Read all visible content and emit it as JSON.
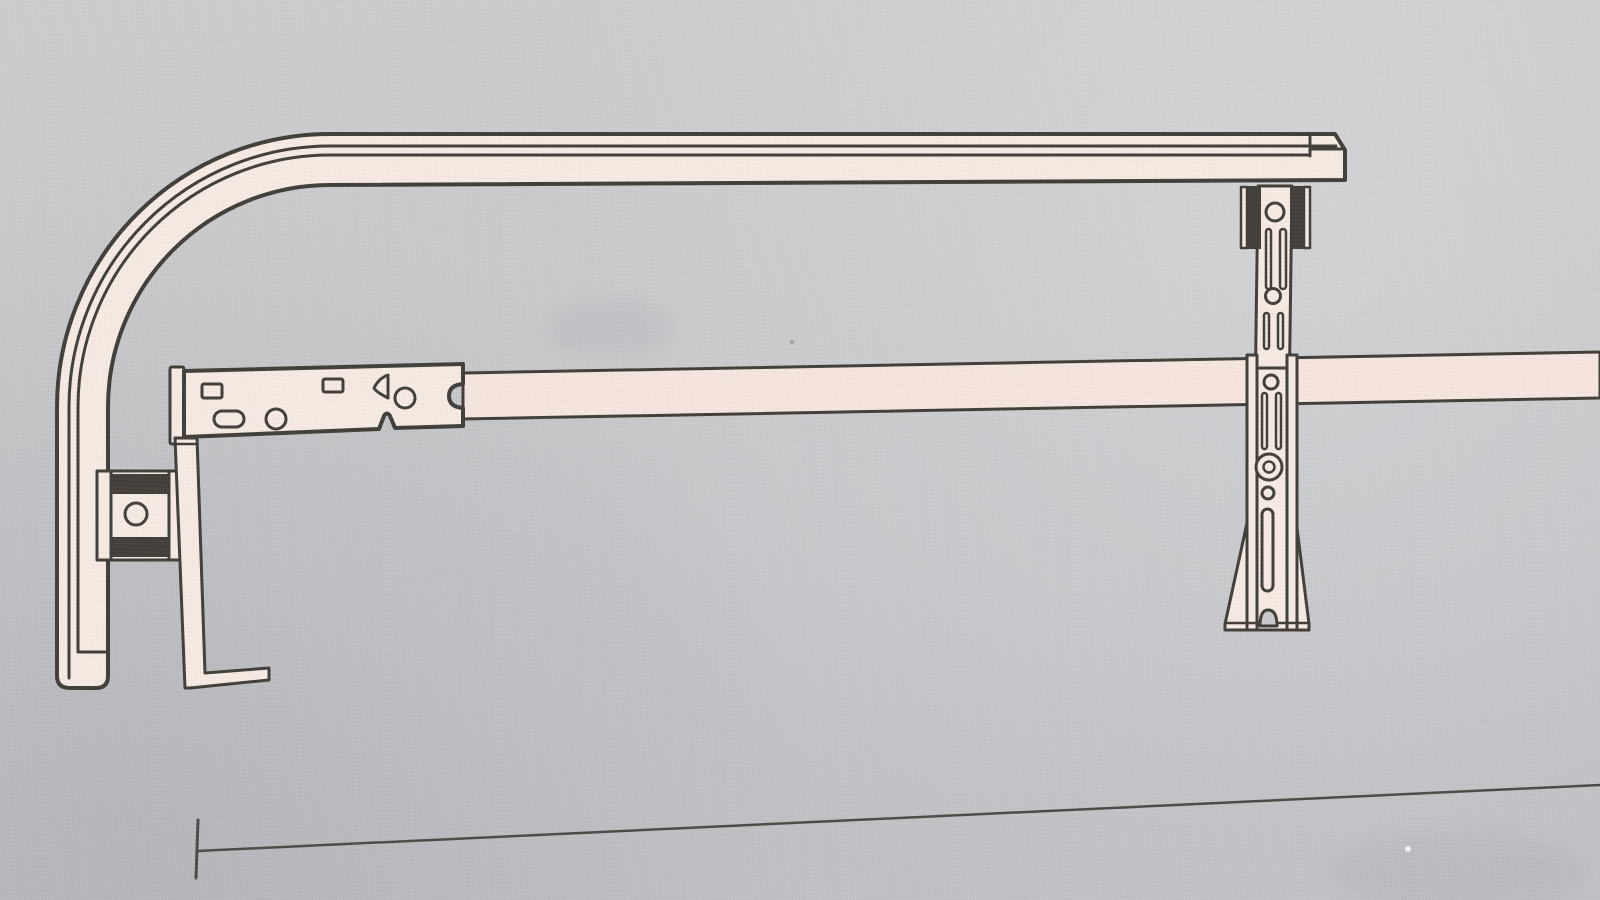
{
  "figure": {
    "type": "technical-line-drawing-photo",
    "description": "Photograph of a printed black-line assembly diagram on grey paper: a curved top rail, a long horizontal support bar with a slotted mounting plate and drop leg, a clamp block, an adjustable slotted upright with splayed foot sleeve, and a long thin dimension line near the bottom."
  },
  "colors": {
    "paper": "#c8c9cb",
    "paper_light": "#d7d6d4",
    "paper_dark": "#bfc1c5",
    "part_fill": "#f7ebe3",
    "part_fill_pink": "#f7e6df",
    "line": "#3e3a35",
    "line_soft": "#4a4644",
    "dark_fill": "#403b36"
  },
  "parts": [
    {
      "id": "top-rail",
      "name": "curved top rail tube"
    },
    {
      "id": "support-bar",
      "name": "horizontal support bar"
    },
    {
      "id": "mounting-plate",
      "name": "slotted mounting plate"
    },
    {
      "id": "drop-leg",
      "name": "drop leg with foot"
    },
    {
      "id": "clamp-block",
      "name": "clamp block with bolt hole"
    },
    {
      "id": "upright",
      "name": "adjustable slotted upright"
    },
    {
      "id": "rail-clamp-pads",
      "name": "dark rail clamp pads"
    },
    {
      "id": "lower-sleeve",
      "name": "lower sleeve with splayed fins"
    },
    {
      "id": "dimension-line",
      "name": "dimension line with end tick"
    }
  ]
}
